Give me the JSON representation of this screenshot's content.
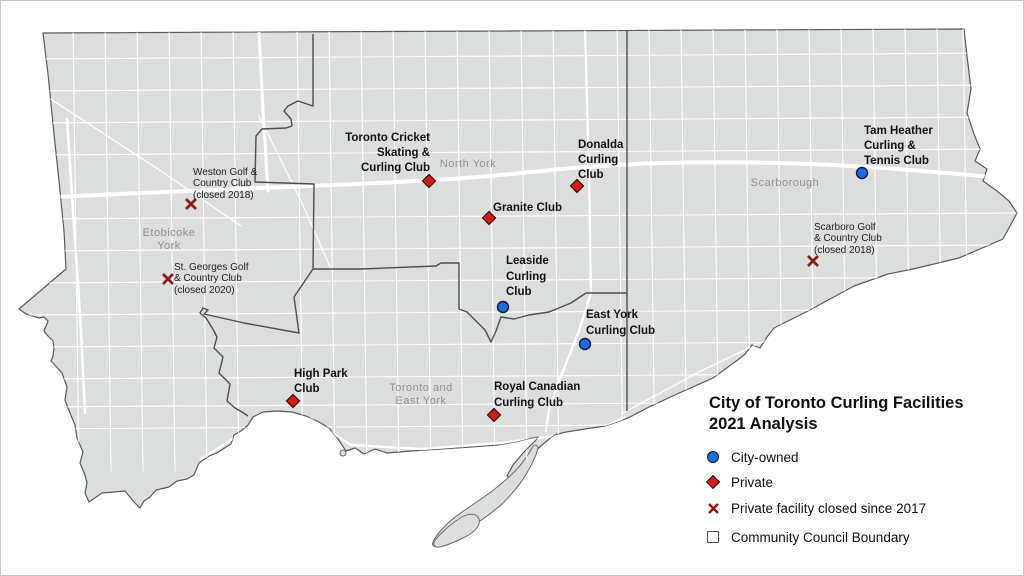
{
  "legend": {
    "title": "City of Toronto Curling Facilities\n2021 Analysis",
    "items": [
      {
        "label": "City-owned",
        "symbol": "city-owned-circle",
        "color": "#1e6be0"
      },
      {
        "label": "Private",
        "symbol": "private-diamond",
        "color": "#d41c1c"
      },
      {
        "label": "Private facility closed since 2017",
        "symbol": "closed-x-mark",
        "color": "#8e1b1b"
      },
      {
        "label": "Community Council Boundary",
        "symbol": "boundary-square-outline",
        "color": "#4d4d4d"
      }
    ]
  },
  "districts": [
    {
      "name": "Etobicoke\nYork"
    },
    {
      "name": "North York"
    },
    {
      "name": "Scarborough"
    },
    {
      "name": "Toronto and\nEast York"
    }
  ],
  "facilities": [
    {
      "name": "Weston Golf &\nCountry Club\n(closed 2018)",
      "status": "closed"
    },
    {
      "name": "St. Georges Golf\n& Country Club\n(closed 2020)",
      "status": "closed"
    },
    {
      "name": "Toronto Cricket\nSkating &\nCurling Club",
      "status": "private"
    },
    {
      "name": "Granite Club",
      "status": "private"
    },
    {
      "name": "Donalda\nCurling\nClub",
      "status": "private"
    },
    {
      "name": "Leaside\nCurling\nClub",
      "status": "city-owned"
    },
    {
      "name": "East York\nCurling Club",
      "status": "city-owned"
    },
    {
      "name": "High Park\nClub",
      "status": "private"
    },
    {
      "name": "Royal Canadian\nCurling Club",
      "status": "private"
    },
    {
      "name": "Tam Heather\nCurling &\nTennis Club",
      "status": "city-owned"
    },
    {
      "name": "Scarboro Golf\n& Country Club\n(closed 2018)",
      "status": "closed"
    }
  ],
  "colors": {
    "land": "#dcdddd",
    "water_background": "#ffffff",
    "roads": "#ffffff",
    "district_boundary": "#4d4d4d",
    "city_owned_marker": "#1e6be0",
    "private_marker": "#d41c1c",
    "closed_marker": "#8e1b1b",
    "district_label": "#8f8f8f"
  }
}
